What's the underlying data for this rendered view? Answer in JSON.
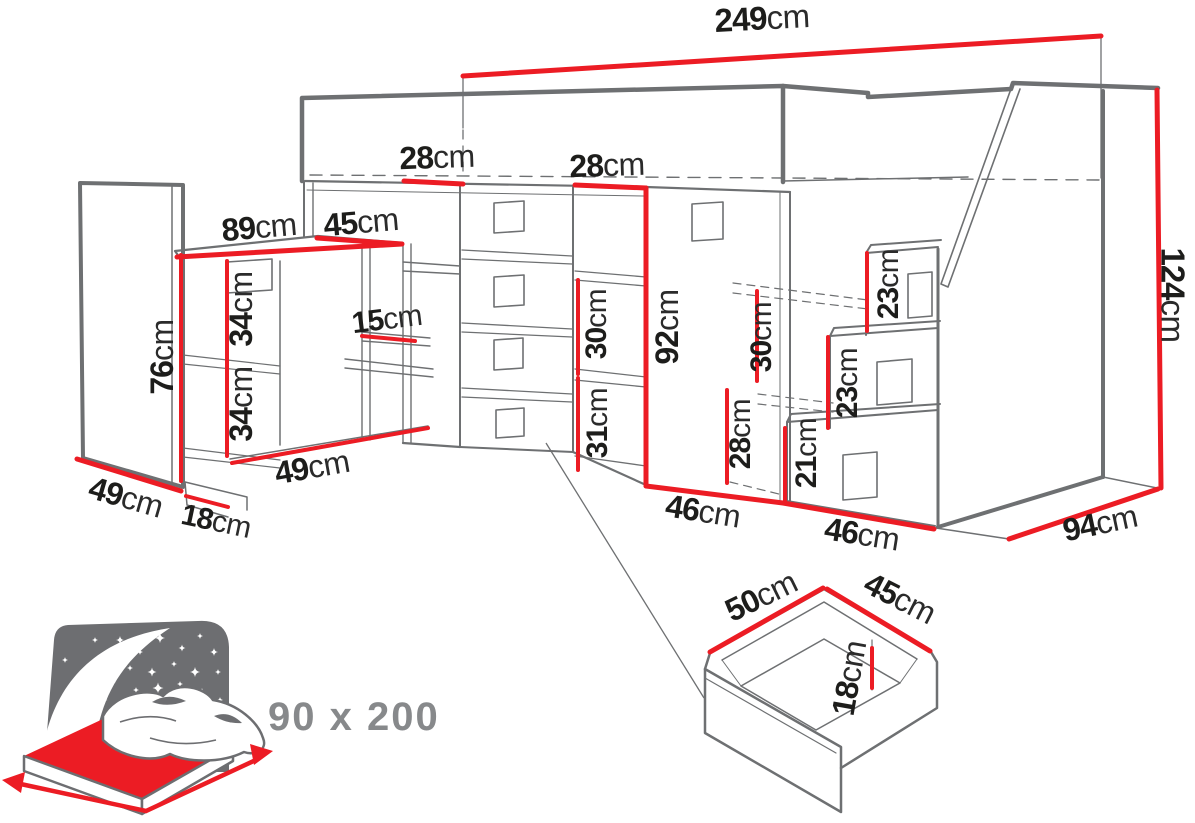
{
  "diagram": {
    "description": "loft-bed-with-desk-stairs-dimension-drawing",
    "colors": {
      "dimension_red": "#ec1c24",
      "line_grey": "#6e7072",
      "label_black": "#1d1d1b",
      "icon_grey": "#6d6e71",
      "size_text_grey": "#87898b"
    },
    "bed_icon": {
      "size_label": "90 x 200"
    },
    "dimensions": [
      {
        "id": "overall-width",
        "value": "249",
        "unit": "cm",
        "x": 762,
        "y": 18,
        "rot": -3,
        "size": 33
      },
      {
        "id": "top-shelf-gap-1",
        "value": "28",
        "unit": "cm",
        "x": 437,
        "y": 157,
        "rot": -2,
        "size": 32
      },
      {
        "id": "top-shelf-gap-2",
        "value": "28",
        "unit": "cm",
        "x": 607,
        "y": 165,
        "rot": -2,
        "size": 32
      },
      {
        "id": "desk-width",
        "value": "89",
        "unit": "cm",
        "x": 259,
        "y": 227,
        "rot": -5,
        "size": 32
      },
      {
        "id": "desk-return-width",
        "value": "45",
        "unit": "cm",
        "x": 361,
        "y": 222,
        "rot": -5,
        "size": 32
      },
      {
        "id": "desk-side-height",
        "value": "76",
        "unit": "cm",
        "x": 162,
        "y": 357,
        "rot": -90,
        "size": 32
      },
      {
        "id": "desk-shelf-gap-upper",
        "value": "34",
        "unit": "cm",
        "x": 241,
        "y": 309,
        "rot": -90,
        "size": 32
      },
      {
        "id": "desk-shelf-gap-lower",
        "value": "34",
        "unit": "cm",
        "x": 241,
        "y": 404,
        "rot": -90,
        "size": 32
      },
      {
        "id": "hutch-shelf-gap",
        "value": "15",
        "unit": "cm",
        "x": 387,
        "y": 320,
        "rot": -7,
        "size": 30
      },
      {
        "id": "left-cabinet-depth",
        "value": "49",
        "unit": "cm",
        "x": 126,
        "y": 497,
        "rot": 16,
        "size": 32
      },
      {
        "id": "desk-base-height",
        "value": "18",
        "unit": "cm",
        "x": 216,
        "y": 522,
        "rot": 12,
        "size": 30
      },
      {
        "id": "desk-depth",
        "value": "49",
        "unit": "cm",
        "x": 312,
        "y": 467,
        "rot": -10,
        "size": 32
      },
      {
        "id": "mid-shelf-gap-upper",
        "value": "30",
        "unit": "cm",
        "x": 597,
        "y": 324,
        "rot": -90,
        "size": 30
      },
      {
        "id": "mid-shelf-gap-lower",
        "value": "31",
        "unit": "cm",
        "x": 598,
        "y": 423,
        "rot": -90,
        "size": 30
      },
      {
        "id": "wardrobe-door-height",
        "value": "92",
        "unit": "cm",
        "x": 667,
        "y": 327,
        "rot": -90,
        "size": 32
      },
      {
        "id": "stair-shelf-gap-upper",
        "value": "30",
        "unit": "cm",
        "x": 762,
        "y": 337,
        "rot": -90,
        "size": 30
      },
      {
        "id": "stair-shelf-gap-lower",
        "value": "28",
        "unit": "cm",
        "x": 741,
        "y": 434,
        "rot": -90,
        "size": 30
      },
      {
        "id": "step-3-height",
        "value": "23",
        "unit": "cm",
        "x": 889,
        "y": 284,
        "rot": -90,
        "size": 30
      },
      {
        "id": "step-2-height",
        "value": "23",
        "unit": "cm",
        "x": 848,
        "y": 383,
        "rot": -90,
        "size": 30
      },
      {
        "id": "step-1-height",
        "value": "21",
        "unit": "cm",
        "x": 807,
        "y": 453,
        "rot": -90,
        "size": 30
      },
      {
        "id": "wardrobe-width",
        "value": "46",
        "unit": "cm",
        "x": 703,
        "y": 511,
        "rot": 9,
        "size": 32
      },
      {
        "id": "stairs-width",
        "value": "46",
        "unit": "cm",
        "x": 862,
        "y": 534,
        "rot": 9,
        "size": 32
      },
      {
        "id": "side-depth",
        "value": "94",
        "unit": "cm",
        "x": 1100,
        "y": 523,
        "rot": -12,
        "size": 32
      },
      {
        "id": "overall-height",
        "value": "124",
        "unit": "cm",
        "x": 1173,
        "y": 295,
        "rot": 90,
        "size": 33
      },
      {
        "id": "drawer-width",
        "value": "50",
        "unit": "cm",
        "x": 761,
        "y": 596,
        "rot": -26,
        "size": 32
      },
      {
        "id": "drawer-depth",
        "value": "45",
        "unit": "cm",
        "x": 900,
        "y": 598,
        "rot": 27,
        "size": 32
      },
      {
        "id": "drawer-height",
        "value": "18",
        "unit": "cm",
        "x": 849,
        "y": 678,
        "rot": -80,
        "size": 32
      }
    ]
  }
}
